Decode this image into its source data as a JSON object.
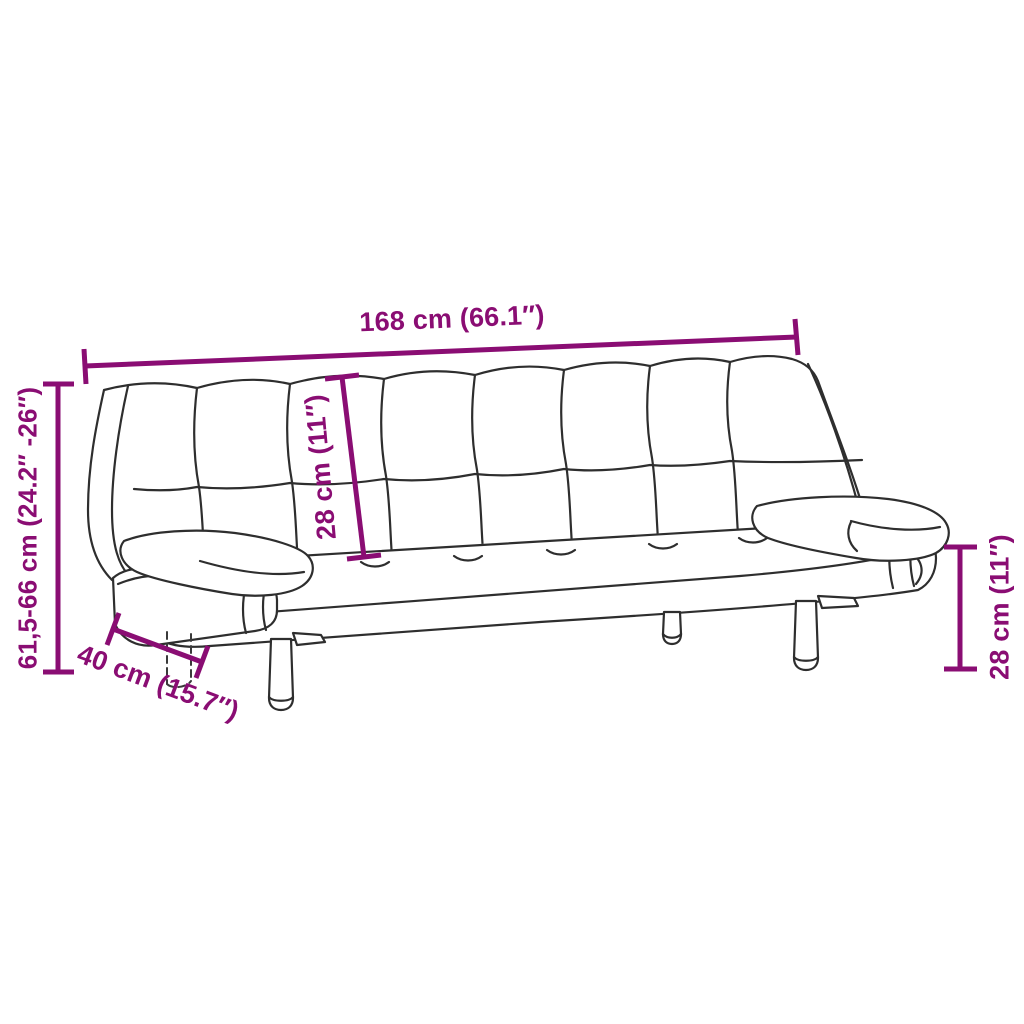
{
  "image": {
    "kind": "product-dimension-diagram",
    "subject": "sofa-bed-line-drawing-with-armrest-cushions",
    "background_color": "#ffffff"
  },
  "colors": {
    "dimension_accent": "#8A0D73",
    "drawing_line": "#2E2E2E"
  },
  "dimensions": {
    "overall_width": {
      "label": "168 cm (66.1″)"
    },
    "overall_height": {
      "label": "61,5-66 cm (24.2″ -26″)"
    },
    "backrest_height": {
      "label": "28 cm (11″)"
    },
    "leg_height": {
      "label": "28 cm (11″)"
    },
    "depth": {
      "label": "40 cm (15.7″)"
    }
  }
}
